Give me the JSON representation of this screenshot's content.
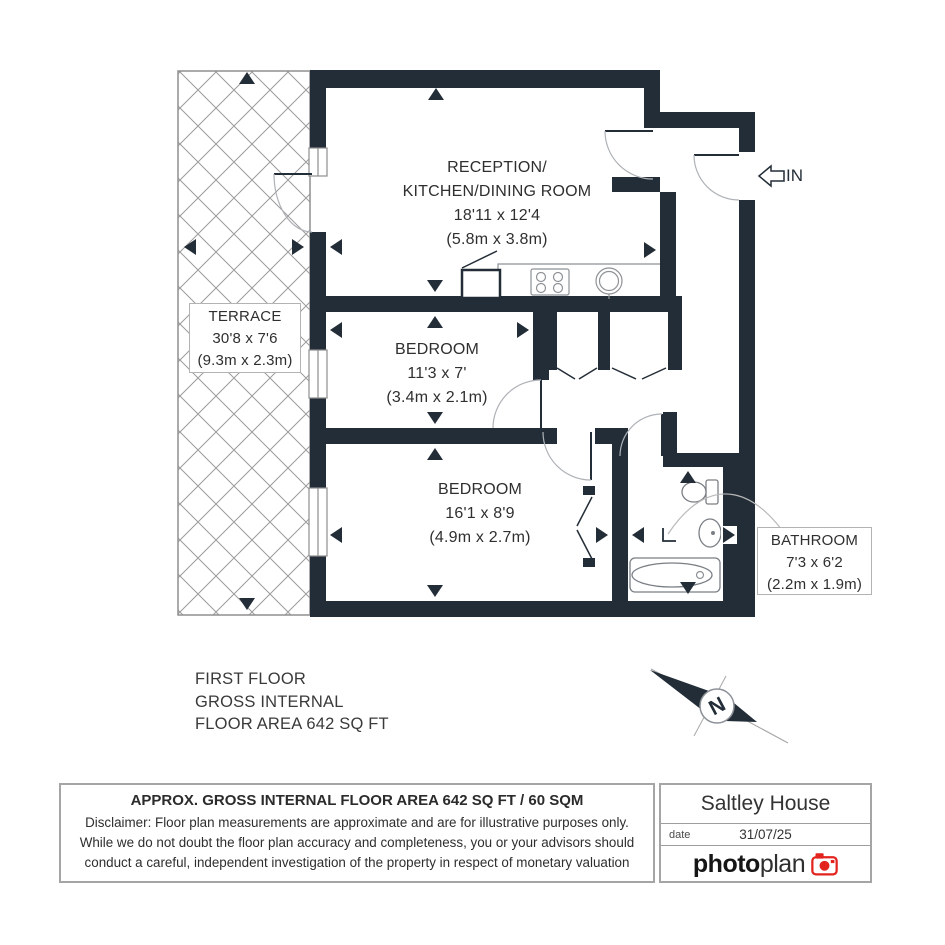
{
  "plan": {
    "terrace": {
      "name": "TERRACE",
      "imperial": "30'8 x 7'6",
      "metric": "(9.3m x 2.3m)"
    },
    "reception": {
      "name_line1": "RECEPTION/",
      "name_line2": "KITCHEN/DINING ROOM",
      "imperial": "18'11 x 12'4",
      "metric": "(5.8m x 3.8m)"
    },
    "bedroom1": {
      "name": "BEDROOM",
      "imperial": "11'3 x 7'",
      "metric": "(3.4m x 2.1m)"
    },
    "bedroom2": {
      "name": "BEDROOM",
      "imperial": "16'1 x 8'9",
      "metric": "(4.9m x 2.7m)"
    },
    "bathroom": {
      "name": "BATHROOM",
      "imperial": "7'3 x 6'2",
      "metric": "(2.2m x 1.9m)"
    },
    "entrance_label": "IN",
    "compass_label": "N"
  },
  "floor_summary": {
    "line1": "FIRST FLOOR",
    "line2": "GROSS INTERNAL",
    "line3": "FLOOR AREA 642 SQ FT"
  },
  "footer": {
    "area_title": "APPROX. GROSS INTERNAL FLOOR AREA 642 SQ FT / 60 SQM",
    "disclaimer_lines": [
      "Disclaimer: Floor plan measurements are approximate and are for illustrative purposes only.",
      "While we do not doubt the floor plan accuracy and completeness, you or your advisors should",
      "conduct a careful, independent investigation of the property in respect of monetary valuation"
    ],
    "property_name": "Saltley House",
    "date_label": "date",
    "date_value": "31/07/25",
    "logo_part1": "photo",
    "logo_part2": "plan"
  },
  "colors": {
    "wall_dark": "#232d37",
    "logo_red": "#e3231d"
  }
}
